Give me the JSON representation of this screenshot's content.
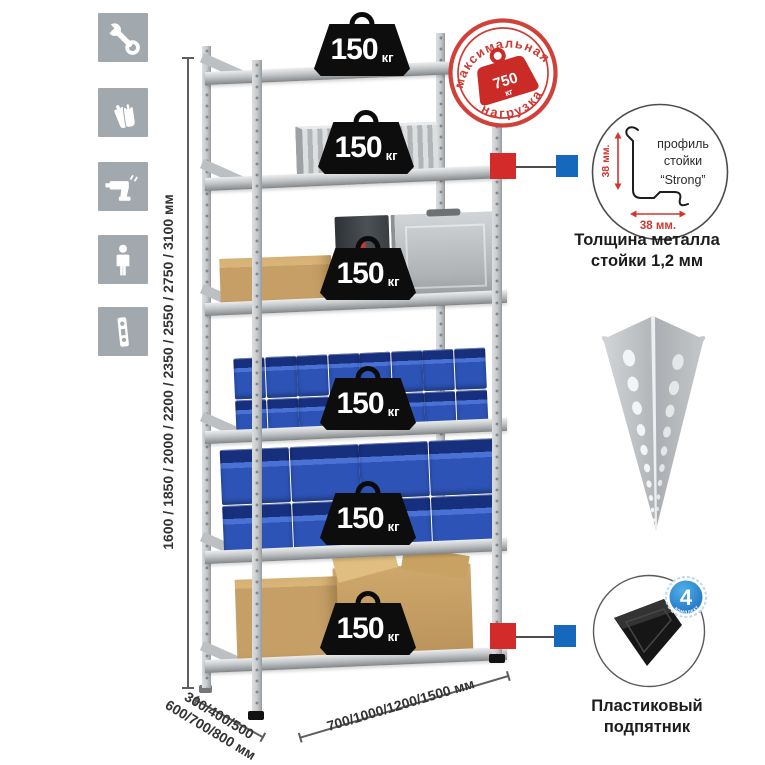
{
  "colors": {
    "accent_red": "#d32a2a",
    "accent_blue": "#1668bd",
    "bin_blue": "#2c53b5",
    "icon_gray": "#a2a9ae"
  },
  "left_icons": {
    "items": [
      "wrench",
      "gloves",
      "drill",
      "person",
      "perforated-strip"
    ]
  },
  "dimensions": {
    "height_label": "1600 / 1850 / 2000 / 2200 / 2350 / 2550 / 2750 / 3100 мм",
    "depth_line1": "300/400/500",
    "depth_line2": "600/700/800 мм",
    "width_label": "700/1000/1200/1500 мм"
  },
  "max_load_stamp": {
    "arc_top": "максимальная",
    "arc_bottom": "нагрузка",
    "value": "750",
    "unit": "кг"
  },
  "shelf_load": {
    "value": "150",
    "unit": "кг"
  },
  "post_profile": {
    "title_line1": "профиль",
    "title_line2": "стойки",
    "title_line3": "“Strong”",
    "vertical_dim": "38 мм.",
    "horizontal_dim": "38 мм.",
    "caption_line1": "Толщина металла",
    "caption_line2": "стойки 1,2 мм"
  },
  "foot_detail": {
    "badge_value": "4",
    "badge_ring_text": "в комплекте",
    "caption_line1": "Пластиковый",
    "caption_line2": "подпятник"
  }
}
